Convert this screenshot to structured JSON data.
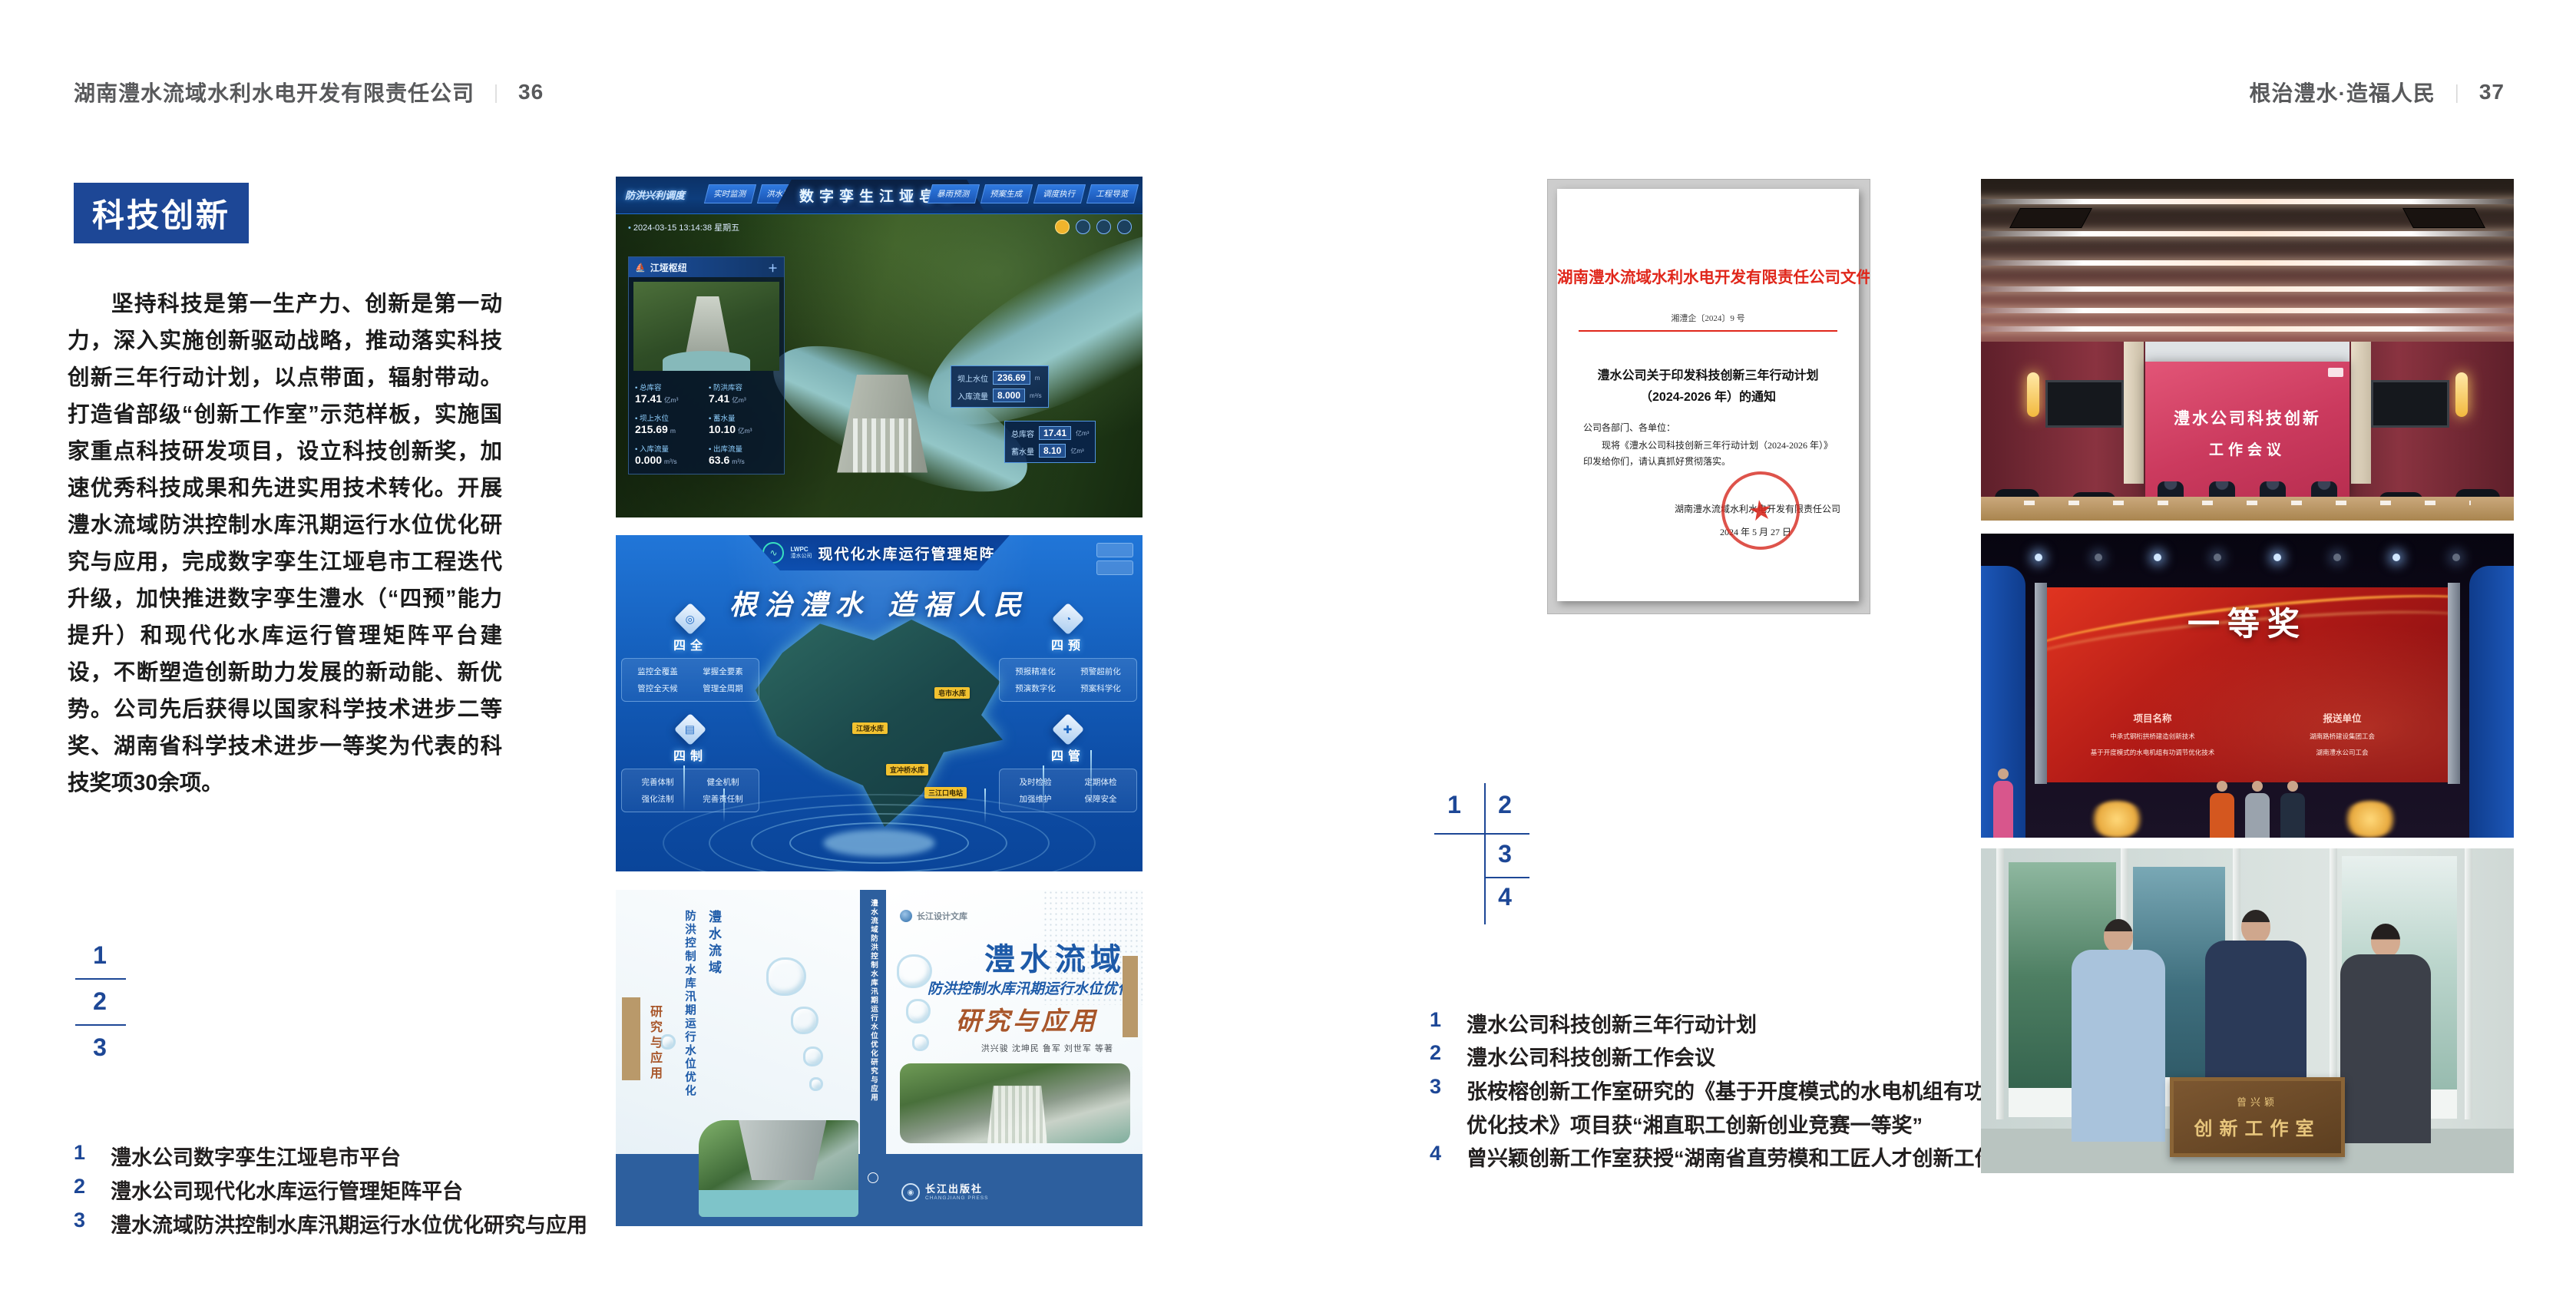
{
  "left_page": {
    "header_title": "湖南澧水流域水利水电开发有限责任公司",
    "header_divider": "｜",
    "page_number": "36",
    "section_title": "科技创新",
    "paragraph": "坚持科技是第一生产力、创新是第一动力，深入实施创新驱动战略，推动落实科技创新三年行动计划，以点带面，辐射带动。打造省部级“创新工作室”示范样板，实施国家重点科技研发项目，设立科技创新奖，加速优秀科技成果和先进实用技术转化。开展澧水流域防洪控制水库汛期运行水位优化研究与应用，完成数字孪生江垭皂市工程迭代升级，加快推进数字孪生澧水（“四预”能力提升）和现代化水库运行管理矩阵平台建设，不断塑造创新助力发展的新动能、新优势。公司先后获得以国家科学技术进步二等奖、湖南省科学技术进步一等奖为代表的科技奖项30余项。",
    "figure_index": {
      "n1": "1",
      "n2": "2",
      "n3": "3"
    },
    "captions": [
      {
        "num": "1",
        "text": "澧水公司数字孪生江垭皂市平台"
      },
      {
        "num": "2",
        "text": "澧水公司现代化水库运行管理矩阵平台"
      },
      {
        "num": "3",
        "text": "澧水流域防洪控制水库汛期运行水位优化研究与应用"
      }
    ]
  },
  "right_page": {
    "header_title": "根治澧水·造福人民",
    "header_divider": "｜",
    "page_number": "37",
    "figure_index": {
      "n1": "1",
      "n2": "2",
      "n3": "3",
      "n4": "4"
    },
    "captions": [
      {
        "num": "1",
        "text": "澧水公司科技创新三年行动计划"
      },
      {
        "num": "2",
        "text": "澧水公司科技创新工作会议"
      },
      {
        "num": "3",
        "text": "张桉榕创新工作室研究的《基于开度模式的水电机组有功调节",
        "text2": "优化技术》项目获“湘直职工创新创业竞赛一等奖”"
      },
      {
        "num": "4",
        "text": "曾兴颖创新工作室获授“湖南省直劳模和工匠人才创新工作室”"
      }
    ]
  },
  "dashboard": {
    "brand": "防洪兴利调度",
    "title": "数字孪生江垭皂市",
    "tabs_left": [
      "实时监测",
      "洪水预报",
      "防洪预警"
    ],
    "tabs_right": [
      "暴雨预测",
      "预案生成",
      "调度执行",
      "工程导览"
    ],
    "datetime": "2024-03-15 13:14:38 星期五",
    "panel_title": "江垭枢纽",
    "stats": [
      {
        "label": "总库容",
        "value": "17.41",
        "unit": "亿m³"
      },
      {
        "label": "防洪库容",
        "value": "7.41",
        "unit": "亿m³"
      },
      {
        "label": "坝上水位",
        "value": "215.69",
        "unit": "m"
      },
      {
        "label": "蓄水量",
        "value": "10.10",
        "unit": "亿m³"
      },
      {
        "label": "入库流量",
        "value": "0.000",
        "unit": "m³/s"
      },
      {
        "label": "出库流量",
        "value": "63.6",
        "unit": "m³/s"
      }
    ],
    "tooltip": [
      {
        "label": "坝上水位",
        "value": "236.69",
        "unit": "m"
      },
      {
        "label": "入库流量",
        "value": "8.000",
        "unit": "m³/s"
      }
    ],
    "panel2": [
      {
        "label": "总库容",
        "value": "17.41",
        "unit": "亿m³"
      },
      {
        "label": "蓄水量",
        "value": "8.10",
        "unit": "亿m³"
      }
    ]
  },
  "matrix": {
    "logo_line1": "LWPC",
    "logo_line2": "澧水公司",
    "title": "现代化水库运行管理矩阵",
    "slogan": "根治澧水 造福人民",
    "groups": [
      {
        "name": "四全",
        "items": [
          "监控全覆盖",
          "掌握全要素",
          "管控全天候",
          "管理全周期"
        ]
      },
      {
        "name": "四预",
        "items": [
          "预报精准化",
          "预警超前化",
          "预演数字化",
          "预案科学化"
        ]
      },
      {
        "name": "四制",
        "items": [
          "完善体制",
          "健全机制",
          "强化法制",
          "完善责任制"
        ]
      },
      {
        "name": "四管",
        "items": [
          "及时检验",
          "定期体检",
          "加强维护",
          "保障安全"
        ]
      }
    ],
    "map_labels": [
      "皂市水库",
      "江垭水库",
      "宜冲桥水库",
      "三江口电站"
    ]
  },
  "book": {
    "series": "长江设计文库",
    "title_region": "澧水流域",
    "title_sub": "防洪控制水库汛期运行水位优化",
    "title_main": "研究与应用",
    "authors": "洪兴骏 沈坤民 鲁军 刘世军 等著",
    "spine": "澧水流域防洪控制水库汛期运行水位优化研究与应用",
    "publisher": "长江出版社",
    "publisher_en": "CHANGJIANG PRESS"
  },
  "document": {
    "masthead": "湖南澧水流域水利水电开发有限责任公司文件",
    "doc_no": "湘澧企〔2024〕9 号",
    "title_line1": "澧水公司关于印发科技创新三年行动计划",
    "title_line2": "（2024-2026 年）的通知",
    "salutation": "公司各部门、各单位：",
    "body": "现将《澧水公司科技创新三年行动计划（2024-2026 年）》印发给你们，请认真抓好贯彻落实。",
    "signer": "湖南澧水流域水利水电开发有限责任公司",
    "date": "2024 年 5 月 27 日"
  },
  "meeting": {
    "screen_line1": "澧水公司科技创新",
    "screen_line2": "工作会议"
  },
  "award": {
    "title": "一等奖",
    "col1": "项目名称",
    "col2": "报送单位",
    "rows": [
      {
        "project": "中承式钢桁拱桥建造创新技术",
        "unit": "湖南路桥建设集团工会"
      },
      {
        "project": "基于开度模式的水电机组有功调节优化技术",
        "unit": "湖南澧水公司工会"
      }
    ]
  },
  "plaque": {
    "line1": "曾兴颖",
    "line2": "创新工作室"
  }
}
